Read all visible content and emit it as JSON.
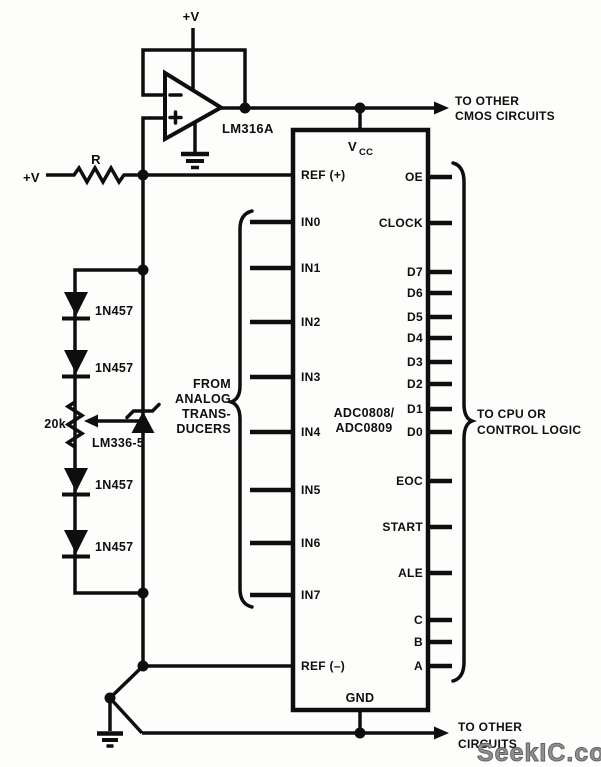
{
  "colors": {
    "ink": "#0e0e0e",
    "background": "#fdfdfc",
    "watermark_gray": "#8f8f8f"
  },
  "power": {
    "top_supply": "+V",
    "left_supply": "+V"
  },
  "opamp": {
    "label": "LM316A"
  },
  "resistor": {
    "label": "R"
  },
  "potentiometer": {
    "label": "20k"
  },
  "voltage_reference": {
    "label": "LM336-5"
  },
  "diodes": {
    "d1": "1N457",
    "d2": "1N457",
    "d3": "1N457",
    "d4": "1N457"
  },
  "ic": {
    "name_line1": "ADC0808/",
    "name_line2": "ADC0809",
    "vcc_main": "V",
    "vcc_sub": "CC",
    "gnd": "GND",
    "left_pins": [
      "REF (+)",
      "IN0",
      "IN1",
      "IN2",
      "IN3",
      "IN4",
      "IN5",
      "IN6",
      "IN7",
      "REF (–)"
    ],
    "right_pins": [
      "OE",
      "CLOCK",
      "D7",
      "D6",
      "D5",
      "D4",
      "D3",
      "D2",
      "D1",
      "D0",
      "EOC",
      "START",
      "ALE",
      "C",
      "B",
      "A"
    ]
  },
  "annotations": {
    "from_analog_line1": "FROM",
    "from_analog_line2": "ANALOG",
    "from_analog_line3": "TRANS-",
    "from_analog_line4": "DUCERS",
    "to_cmos_line1": "TO OTHER",
    "to_cmos_line2": "CMOS CIRCUITS",
    "to_cpu_line1": "TO CPU OR",
    "to_cpu_line2": "CONTROL LOGIC",
    "to_other_line1": "TO OTHER",
    "to_other_line2": "CIRCUITS"
  },
  "watermark": "SeekIC.com"
}
